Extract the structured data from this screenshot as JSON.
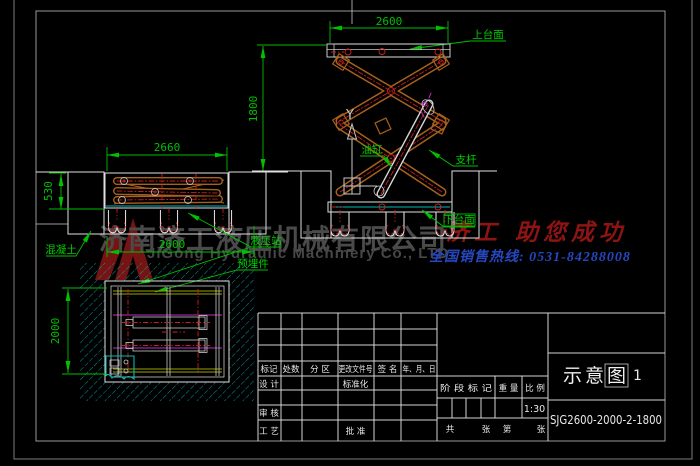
{
  "watermark": {
    "logo": "jigong-triangle-logo",
    "company_cn": "济南济工液压机械有限公司",
    "company_en": "JiGong Hydraulic Machinery Co., LTD",
    "slogan": "济工 助您成功",
    "hotline": "全国销售热线: 0531-84288008"
  },
  "annotations": {
    "upper_platform": "上台面",
    "lower_platform": "下台面",
    "oil_cylinder": "油缸",
    "support_rod": "支杆",
    "concrete": "混凝土",
    "hydraulic_station": "液压站",
    "embedded_parts": "预埋件",
    "ucs_axis": "Y"
  },
  "dimensions": {
    "platform_width_top": "2600",
    "lift_height": "1800",
    "side_platform_length": "2660",
    "closed_height": "530",
    "pit_length": "2600",
    "pit_width": "2000"
  },
  "title_block": {
    "headers": {
      "mark": "标记",
      "count": "处数",
      "zone": "分 区",
      "change_doc_no": "更改文件号",
      "signature": "签 名",
      "date": "年、月、日"
    },
    "design": "设 计",
    "standardization": "标准化",
    "review": "审 核",
    "process": "工 艺",
    "approve": "批 准",
    "stage_mark": "阶 段 标 记",
    "weight": "重 量",
    "scale_label": "比 例",
    "scale_value": "1:30",
    "sheet_row": [
      "共",
      "张",
      "第",
      "张"
    ],
    "drawing_title": "示意图",
    "title_cursor": "1",
    "drawing_no": "SJG2600-2000-2-1800"
  },
  "colors": {
    "background": "#000000",
    "dimension_green": "#00c000",
    "linework_white": "#e0e0e0",
    "arm_orange": "#a8601a",
    "centerline_red": "#cc2020",
    "hatch_cyan": "#00a8a8",
    "detail_magenta": "#bb30bb",
    "plan_yellow": "#9aa000",
    "watermark_gray": "#4a4a4a",
    "slogan_red": "#8e1414",
    "hotline_blue": "#2747c0"
  }
}
